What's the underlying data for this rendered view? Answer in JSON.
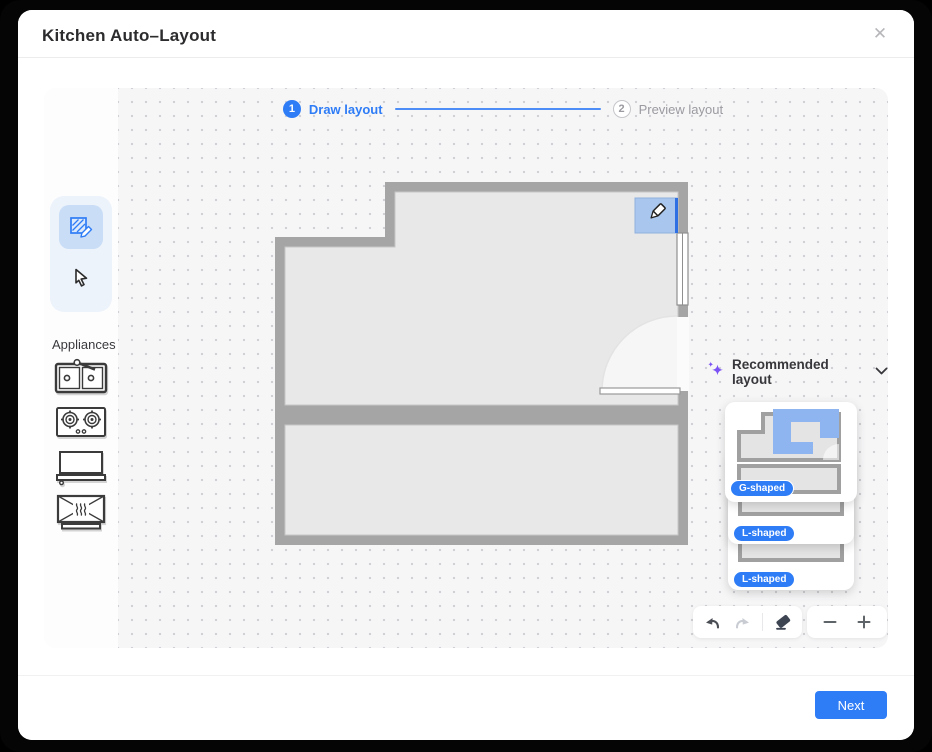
{
  "dialog": {
    "title": "Kitchen Auto–Layout",
    "close_glyph": "✕"
  },
  "stepper": {
    "step1": {
      "number": "1",
      "label": "Draw layout",
      "state": "active"
    },
    "step2": {
      "number": "2",
      "label": "Preview layout",
      "state": "inactive"
    }
  },
  "left_panel": {
    "tools": [
      {
        "name": "draw",
        "active": true
      },
      {
        "name": "select",
        "active": false
      }
    ],
    "appliances_label": "Appliances",
    "appliances": [
      {
        "name": "sink"
      },
      {
        "name": "cooktop"
      },
      {
        "name": "range-hood"
      },
      {
        "name": "oven"
      }
    ]
  },
  "recommended": {
    "label": "Recommended layout",
    "cards": [
      {
        "badge": "G-shaped"
      },
      {
        "badge": "L-shaped"
      },
      {
        "badge": "L-shaped"
      }
    ]
  },
  "canvas_toolbar": {
    "icons": [
      "undo",
      "redo",
      "eraser"
    ],
    "zoom_icons": [
      "zoom-out",
      "zoom-in"
    ],
    "redo_disabled": true
  },
  "footer": {
    "next_label": "Next"
  },
  "colors": {
    "accent": "#2E7CF6",
    "badge_blue": "#2E7CF6",
    "sparkle_purple": "#7B52F4",
    "wall_gray": "#A5A5A5",
    "room_fill": "#E8E8E8",
    "canvas_bg": "#F6F6F7"
  }
}
